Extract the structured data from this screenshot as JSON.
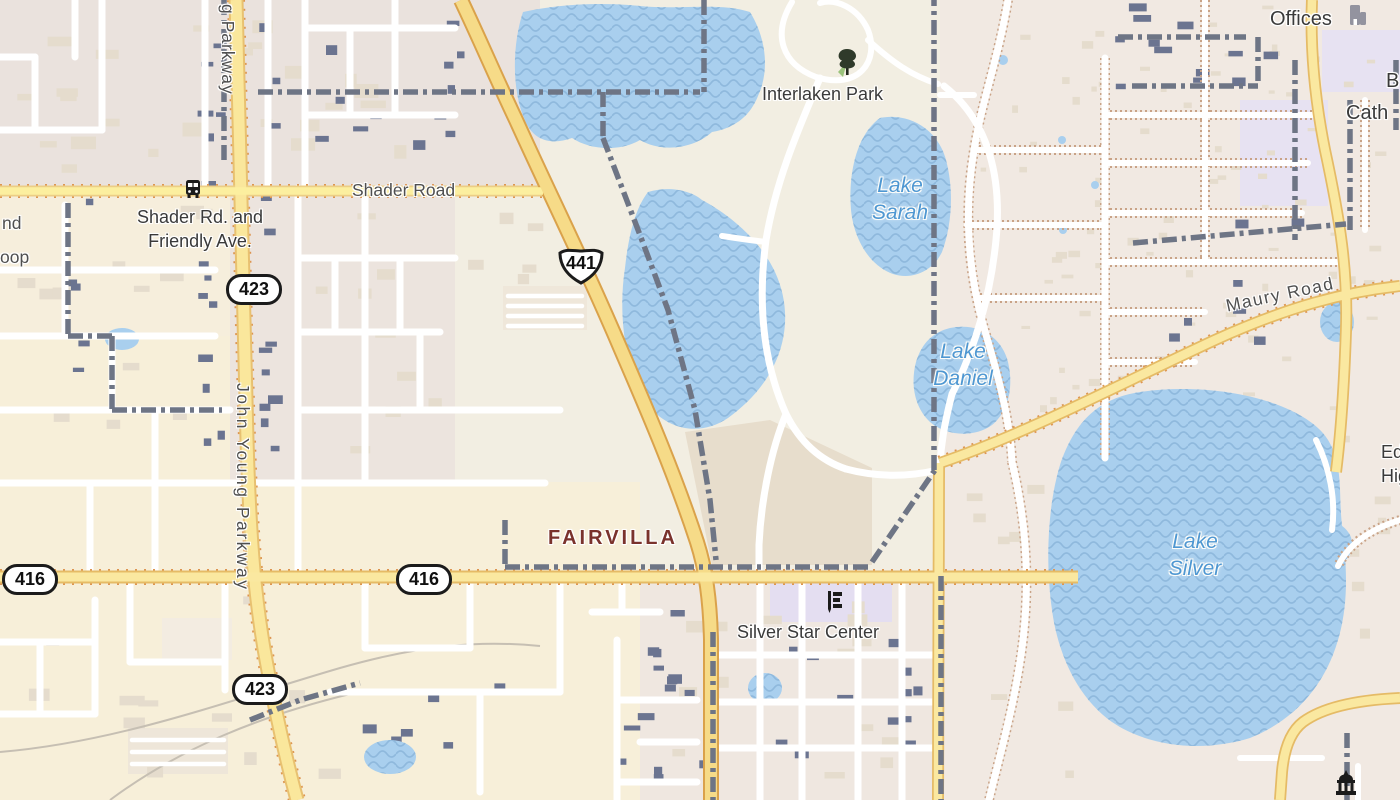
{
  "labels": {
    "partial_parkway_top": "g Parkway",
    "shader_road": "Shader Road",
    "bus_stop_line1": "Shader Rd. and",
    "bus_stop_line2": "Friendly Ave.",
    "partial_nd": "nd",
    "partial_oop": "oop",
    "john_young_parkway": "John Young Parkway",
    "fairvilla": "FAIRVILLA",
    "interlaken_park": "Interlaken Park",
    "silver_star_center": "Silver Star Center",
    "maury_road": "Maury Road",
    "offices": "Offices",
    "partial_b": "B",
    "partial_cath": "Cath",
    "partial_edg": "Edg",
    "partial_high": "High"
  },
  "lakes": {
    "sarah": {
      "line1": "Lake",
      "line2": "Sarah"
    },
    "daniel": {
      "line1": "Lake",
      "line2": "Daniel"
    },
    "silver": {
      "line1": "Lake",
      "line2": "Silver"
    }
  },
  "route_shields": [
    {
      "id": "shield-423-north",
      "type": "state-pill",
      "number": "423"
    },
    {
      "id": "shield-441-us",
      "type": "us-shield",
      "number": "441"
    },
    {
      "id": "shield-416-west",
      "type": "state-pill",
      "number": "416"
    },
    {
      "id": "shield-416-mid",
      "type": "state-pill",
      "number": "416"
    },
    {
      "id": "shield-423-south",
      "type": "state-pill",
      "number": "423"
    }
  ],
  "icons": {
    "bus_stop": "bus-icon",
    "park_tree": "tree-icon",
    "school": "school-flag-icon",
    "offices_building": "building-icon",
    "government_building": "government-building-icon"
  },
  "palette": {
    "land": "#f2eee2",
    "urban": "#eae2dd",
    "water": "#a9cfee",
    "water_wave": "#8fb9dd",
    "road_white": "#ffffff",
    "road_yellow": "#fae79c",
    "road_yellow_major": "#f6db88",
    "road_casing": "#e0ae5c",
    "boundary": "#6e7585",
    "building_dark": "#6b7490",
    "building_light": "#e3d9cd",
    "label_text": "#3a3a3a",
    "water_label": "#4e97d2",
    "neighborhood_label": "#7a322c"
  }
}
